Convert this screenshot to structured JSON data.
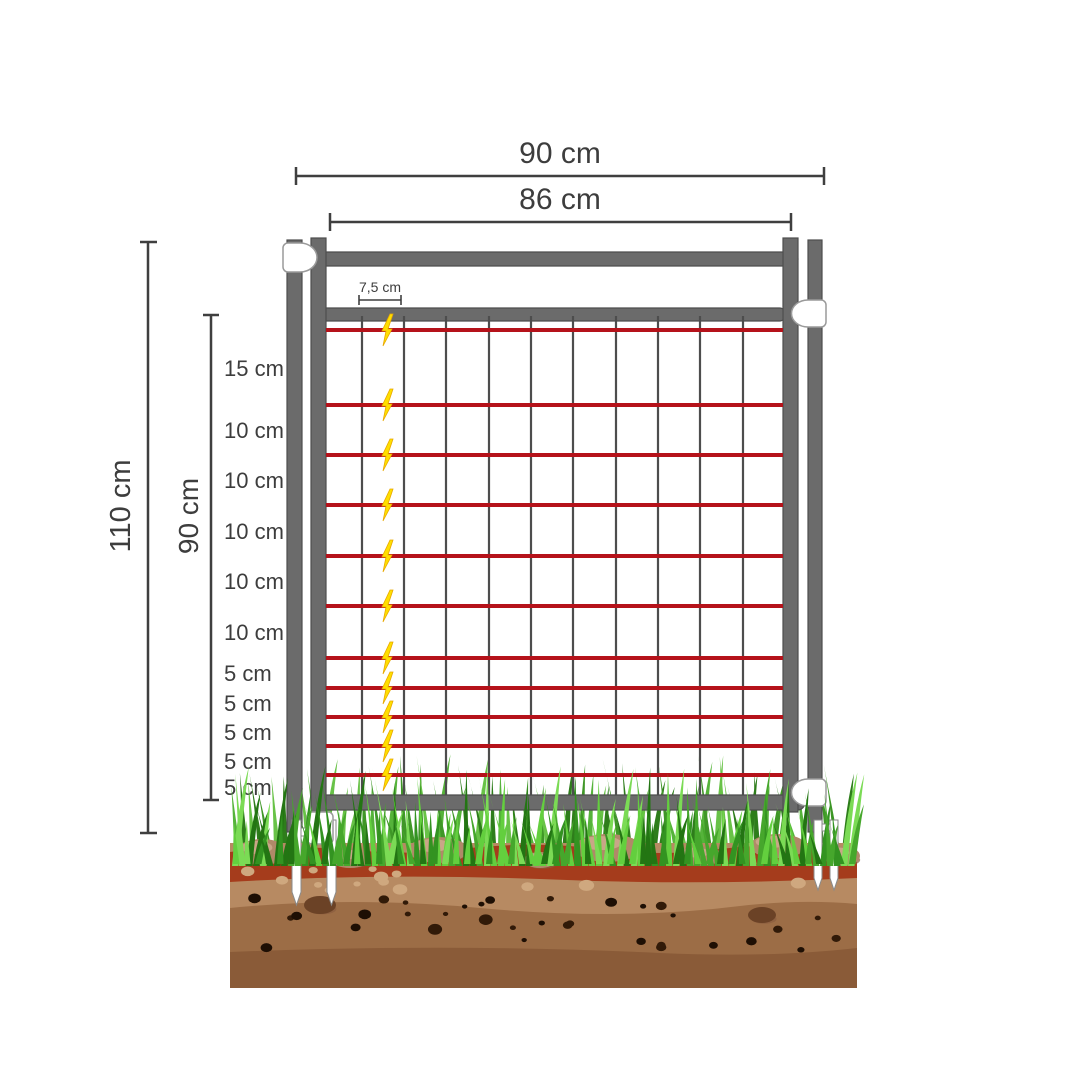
{
  "diagram_subject": "electric-fence-gate-cross-section",
  "dimensions": {
    "width_outer": {
      "label": "90 cm"
    },
    "width_inner": {
      "label": "86 cm"
    },
    "height_total": {
      "label": "110 cm"
    },
    "height_mesh": {
      "label": "90 cm"
    },
    "mesh_spacing": {
      "label": "7,5 cm"
    },
    "wire_gaps": [
      {
        "label": "15 cm"
      },
      {
        "label": "10 cm"
      },
      {
        "label": "10 cm"
      },
      {
        "label": "10 cm"
      },
      {
        "label": "10 cm"
      },
      {
        "label": "10 cm"
      },
      {
        "label": "5 cm"
      },
      {
        "label": "5 cm"
      },
      {
        "label": "5 cm"
      },
      {
        "label": "5 cm"
      },
      {
        "label": "5 cm"
      }
    ]
  },
  "legend": {
    "electrified_wire_icon": "lightning-bolt",
    "wire_count": 11,
    "mesh_vertical_count": 10
  },
  "colors": {
    "text": "#3d3d3d",
    "dimension_line": "#3f3f3f",
    "frame_gray": "#6b6b6b",
    "frame_stroke": "#4e4e4e",
    "mesh_line": "#4d4d4d",
    "wire_red": "#b5121a",
    "bolt_yellow": "#ffdf00",
    "bolt_outline": "#e8a800",
    "connector_white": "#ffffff",
    "grass_back_greens": [
      "#3f9727",
      "#55b33a",
      "#2e7d1b",
      "#68c247"
    ],
    "grass_front_greens": [
      "#46a72c",
      "#63cf3e",
      "#237513",
      "#7bdb55",
      "#339321"
    ],
    "soil_light": "#b78a62",
    "soil_mid": "#9c6d46",
    "soil_dark": "#8a5b38",
    "soil_red_band": "#a53c1c",
    "stone": "#b08968",
    "stone_highlight": "#c9a687",
    "stone_shadow": "#8a5c3e",
    "speckle_dark": "#311a08",
    "speckle_black": "#1e0f04",
    "speckle_light": "#cfa87f"
  }
}
